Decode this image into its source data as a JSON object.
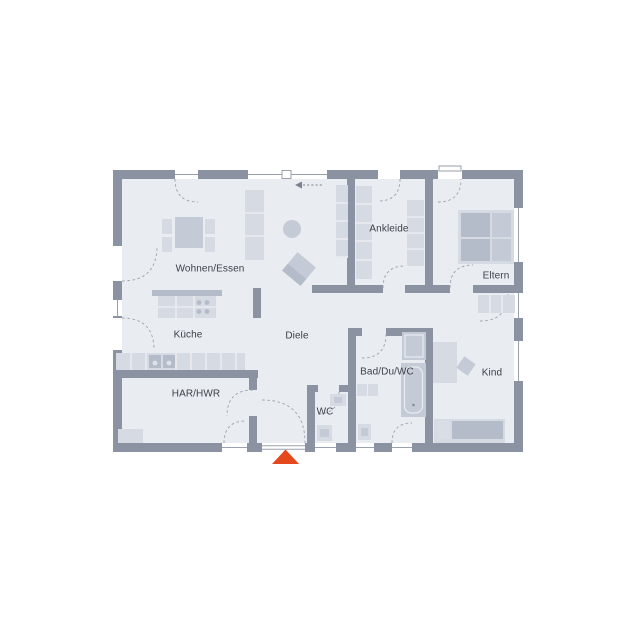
{
  "floorplan": {
    "rooms": {
      "wohnen_essen": "Wohnen/Essen",
      "kueche": "Küche",
      "diele": "Diele",
      "har_hwr": "HAR/HWR",
      "wc": "WC",
      "bad_du_wc": "Bad/Du/WC",
      "ankleide": "Ankleide",
      "eltern": "Eltern",
      "kind": "Kind"
    },
    "colors": {
      "bg": "#ffffff",
      "wall": "#8b93a2",
      "floor": "#e9ecf1",
      "furniture_light": "#d6dbe3",
      "furniture_medium": "#c5cbd6",
      "furniture_dark": "#b4bcc9",
      "line": "#9aa1ae",
      "text": "#3c4049",
      "accent": "#e5481d"
    }
  }
}
